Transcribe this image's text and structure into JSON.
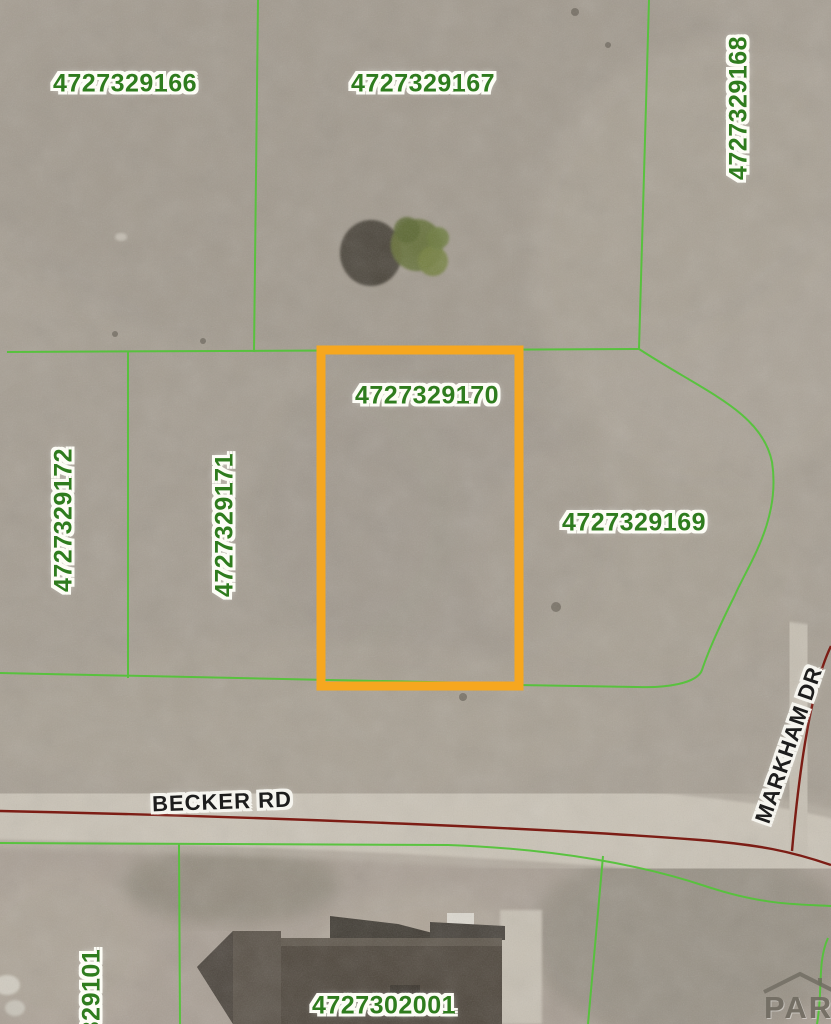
{
  "map": {
    "description": "County assessor aerial parcel map",
    "selected_parcel_id": "4727329170",
    "labels": {
      "p166": "4727329166",
      "p167": "4727329167",
      "p168": "4727329168",
      "p169": "4727329169",
      "p170": "4727329170",
      "p171": "4727329171",
      "p172": "4727329172",
      "p101": "329101",
      "p2001": "4727302001"
    },
    "roads": {
      "becker": "BECKER RD",
      "markham": "MARKHAM DR"
    },
    "watermark": "PAR",
    "colors": {
      "parcel_label_green": "#2f7c1e",
      "boundary_line_green": "#54c33a",
      "selected_outline_orange": "#f6a71f",
      "road_centerline_dark_red": "#7c1d15",
      "road_label_black": "#1d1d1d",
      "terrain_tan": "#a79f93",
      "road_surface_light": "#cac3b6"
    }
  }
}
